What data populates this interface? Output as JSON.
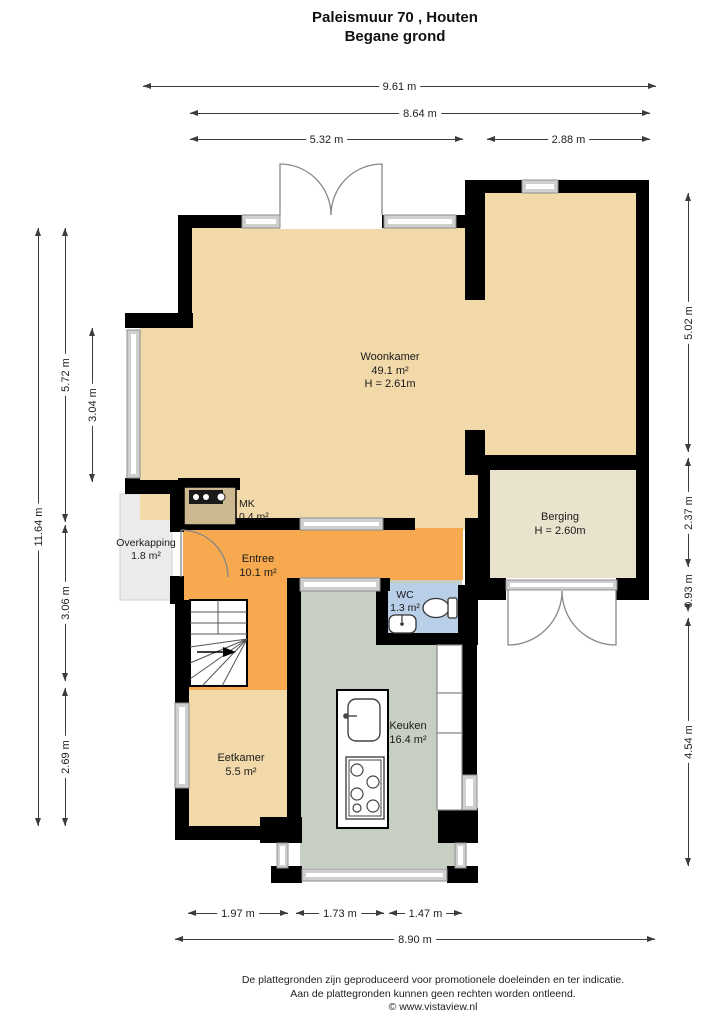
{
  "title": {
    "address": "Paleismuur 70 , Houten",
    "floor": "Begane grond"
  },
  "rooms": {
    "woonkamer": {
      "name": "Woonkamer",
      "area": "49.1 m²",
      "ceiling": "H = 2.61m"
    },
    "berging": {
      "name": "Berging",
      "ceiling": "H = 2.60m"
    },
    "mk": {
      "name": "MK",
      "area": "0.4 m²"
    },
    "overkapping": {
      "name": "Overkapping",
      "area": "1.8 m²"
    },
    "entree": {
      "name": "Entree",
      "area": "10.1 m²"
    },
    "wc": {
      "name": "WC",
      "area": "1.3 m²"
    },
    "keuken": {
      "name": "Keuken",
      "area": "16.4 m²"
    },
    "eetkamer": {
      "name": "Eetkamer",
      "area": "5.5 m²"
    }
  },
  "dims": {
    "top_total": "9.61 m",
    "top_inner": "8.64 m",
    "top_left": "5.32 m",
    "top_right": "2.88 m",
    "left_total": "11.64 m",
    "left_upper": "5.72 m",
    "left_window": "3.04 m",
    "left_mid": "3.06 m",
    "left_lower": "2.69 m",
    "right_upper": "5.02 m",
    "right_mid": "2.37 m",
    "right_small": "0.93 m",
    "right_lower": "4.54 m",
    "bottom_left": "1.97 m",
    "bottom_mid": "1.73 m",
    "bottom_right": "1.47 m",
    "bottom_total": "8.90 m"
  },
  "footer": {
    "line1": "De plattegronden zijn geproduceerd voor promotionele doeleinden en ter indicatie.",
    "line2": "Aan de plattegronden kunnen geen rechten worden ontleend.",
    "line3": "© www.vistaview.nl"
  },
  "colors": {
    "floor_living": "#f2d9a9",
    "floor_storage": "#e9e2cc",
    "floor_hall": "#f6a94e",
    "floor_kitchen": "#c6cfc2",
    "floor_wc": "#b9cfe8",
    "floor_canopy": "#ebebeb",
    "wall": "#000000",
    "window": "#cfcfcf"
  }
}
